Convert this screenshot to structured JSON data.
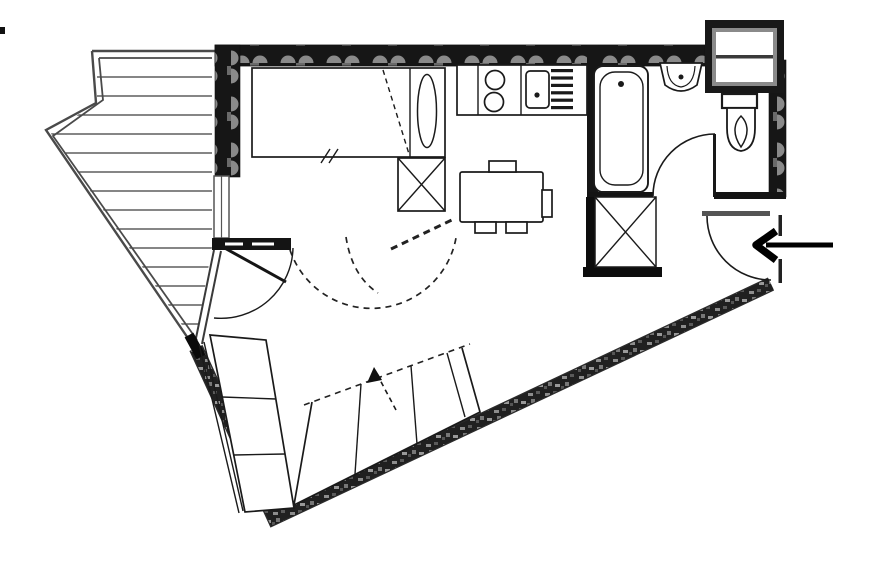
{
  "page": {
    "title": "Studio apartment floor plan",
    "background": "#ffffff",
    "texts_visible": false
  },
  "palette": {
    "ink": "#1a1a1a",
    "wall_fill": "#161616",
    "wall_texture_light": "#8a8a8a",
    "railing_gray": "#4a4a4a",
    "background": "#ffffff"
  },
  "diagram": {
    "type": "floor-plan",
    "style": "monochrome architectural line drawing, no text labels",
    "areas": [
      {
        "name": "balcony",
        "position": "left",
        "features": [
          "angled railing (double line)",
          "horizontal plank decking lines",
          "glazed angled wall to living room",
          "window to sleeping area",
          "balcony door with swing arc"
        ]
      },
      {
        "name": "sleeping-area",
        "position": "top-left",
        "features": [
          "single bed with pillow section",
          "diagonal dashed blanket line",
          "double tick mark on bed edge",
          "wardrobe square marked with X"
        ]
      },
      {
        "name": "kitchen",
        "position": "top-center",
        "features": [
          "counter strip",
          "two-burner hob",
          "sink with drain dot",
          "draining board with bars"
        ]
      },
      {
        "name": "dining-area",
        "position": "center",
        "features": [
          "rectangular table",
          "four chairs (top, right, two bottom)"
        ]
      },
      {
        "name": "bathroom",
        "position": "top-right",
        "features": [
          "bathtub with drain dot",
          "washbasin",
          "door with quarter-circle swing",
          "utility closet marked with X and thick walls"
        ]
      },
      {
        "name": "wc",
        "position": "top-right-corner",
        "features": [
          "toilet with tank",
          "service duct box protruding above wall"
        ]
      },
      {
        "name": "entrance",
        "position": "right",
        "features": [
          "entry door with swing arc",
          "bold arrow pointing left into apartment"
        ]
      },
      {
        "name": "living-room",
        "position": "bottom",
        "features": [
          "L-shaped sofa bed",
          "dashed fold-out arrow",
          "dashed double door swing arcs",
          "hatched angled exterior walls"
        ]
      }
    ],
    "annotations": {
      "entry_arrow_direction": "left",
      "wall_textures": [
        "scalloped insulation hatch on straight exterior walls",
        "rubble hatch on angled lower walls"
      ]
    }
  }
}
